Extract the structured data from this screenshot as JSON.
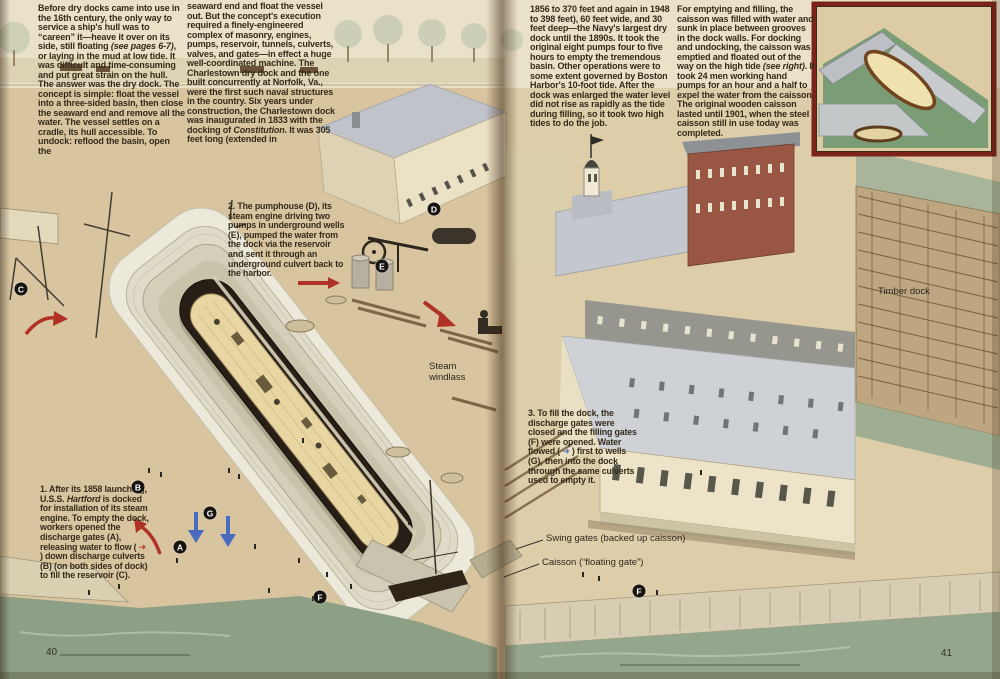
{
  "colors": {
    "paper": "#d8c59f",
    "text": "#352b1b",
    "red_arrow": "#b03226",
    "blue_arrow": "#4a6cc0",
    "water": "#8da086",
    "inset_border": "#7c241c",
    "brick_building": "#995743",
    "marker_bg": "#17130e"
  },
  "article": {
    "col1": [
      {
        "t": "Before dry docks came into use in the 16th century, the only way to service a ship's hull was to “careen” it—heave it over on its side, still floating "
      },
      {
        "t": "(see pages 6-7)",
        "c": "i"
      },
      {
        "t": ", or laying in the mud at low tide. It was difficult and time-consuming and put great strain on the hull. The answer was the dry dock. The concept is simple: float the vessel into a three-sided basin, then close the seaward end and remove all the water. The vessel settles on a cradle, its hull accessible. To undock: reflood the basin, open the"
      }
    ],
    "col2": [
      {
        "t": "seaward end and float the vessel out. But the concept's execution required a finely-engineered complex of masonry, engines, pumps, reservoir, tunnels, culverts, valves, and gates—in effect a huge well-coordinated machine. The Charlestown dry dock and the one built concurrently at Norfolk, Va., were the first such naval structures in the country. Six years under construction, the Charlestown dock was inaugurated in 1833 with the docking of "
      },
      {
        "t": "Constitution",
        "c": "i"
      },
      {
        "t": ". It was 305 feet long (extended in"
      }
    ],
    "col3": [
      {
        "t": "1856 to 370 feet and again in 1948 to 398 feet), 60 feet wide, and 30 feet deep—the Navy's largest dry dock until the 1890s. It took the original eight pumps four to five hours to empty the tremendous basin. Other operations were to some extent governed by Boston Harbor's 10-foot tide. After the dock was enlarged the water level did not rise as rapidly as the tide during filling, so it took two high tides to do the job."
      }
    ],
    "col4": [
      {
        "t": "For emptying and filling, the caisson was filled with water and sunk in place between grooves in the dock walls. For docking and undocking, the caisson was emptied and floated out of the way on the high tide "
      },
      {
        "t": "(see right)",
        "c": "i"
      },
      {
        "t": ". It took 24 men working hand pumps for an hour and a half to expel the water from the caisson. The original wooden caisson lasted until 1901, when the steel caisson still in use today was completed."
      }
    ]
  },
  "captions": {
    "cap1": [
      {
        "t": "1.",
        "c": "b"
      },
      {
        "t": " After its 1858 launching, U.S.S. "
      },
      {
        "t": "Hartford",
        "c": "i"
      },
      {
        "t": " is docked for installation of its steam engine. To empty the dock, workers opened the discharge gates (A), releasing water to flow ( "
      },
      {
        "t": "➜",
        "c": "ar"
      },
      {
        "t": " ) down discharge culverts (B) (on both sides of dock) to fill the reservoir (C)."
      }
    ],
    "cap2": [
      {
        "t": "2.",
        "c": "b"
      },
      {
        "t": " The pumphouse (D), its steam engine driving two pumps in underground wells (E), pumped the water from the dock via the reservoir and sent it through an underground culvert back to the harbor."
      }
    ],
    "cap3": [
      {
        "t": "3.",
        "c": "b"
      },
      {
        "t": " To fill the dock, the discharge gates were closed and the filling gates (F) were opened. Water flowed ( "
      },
      {
        "t": "➜",
        "c": "ab"
      },
      {
        "t": " ) first to wells (G), then into the dock through the same culverts used to empty it."
      }
    ]
  },
  "labels": {
    "steam_windlass": "Steam\nwindlass",
    "timber_dock": "Timber dock",
    "swing_gates": "Swing gates (backed up caisson)",
    "caisson": "Caisson (“floating gate”)"
  },
  "markers": [
    {
      "id": "C",
      "letter": "C",
      "x": 21,
      "y": 289
    },
    {
      "id": "B",
      "letter": "B",
      "x": 138,
      "y": 487
    },
    {
      "id": "A",
      "letter": "A",
      "x": 180,
      "y": 547
    },
    {
      "id": "G",
      "letter": "G",
      "x": 210,
      "y": 513
    },
    {
      "id": "D",
      "letter": "D",
      "x": 434,
      "y": 209
    },
    {
      "id": "E",
      "letter": "E",
      "x": 382,
      "y": 266
    },
    {
      "id": "F1",
      "letter": "F",
      "x": 320,
      "y": 597
    },
    {
      "id": "F2",
      "letter": "F",
      "x": 639,
      "y": 591
    }
  ],
  "page_numbers": {
    "left": "40",
    "right": "41"
  }
}
